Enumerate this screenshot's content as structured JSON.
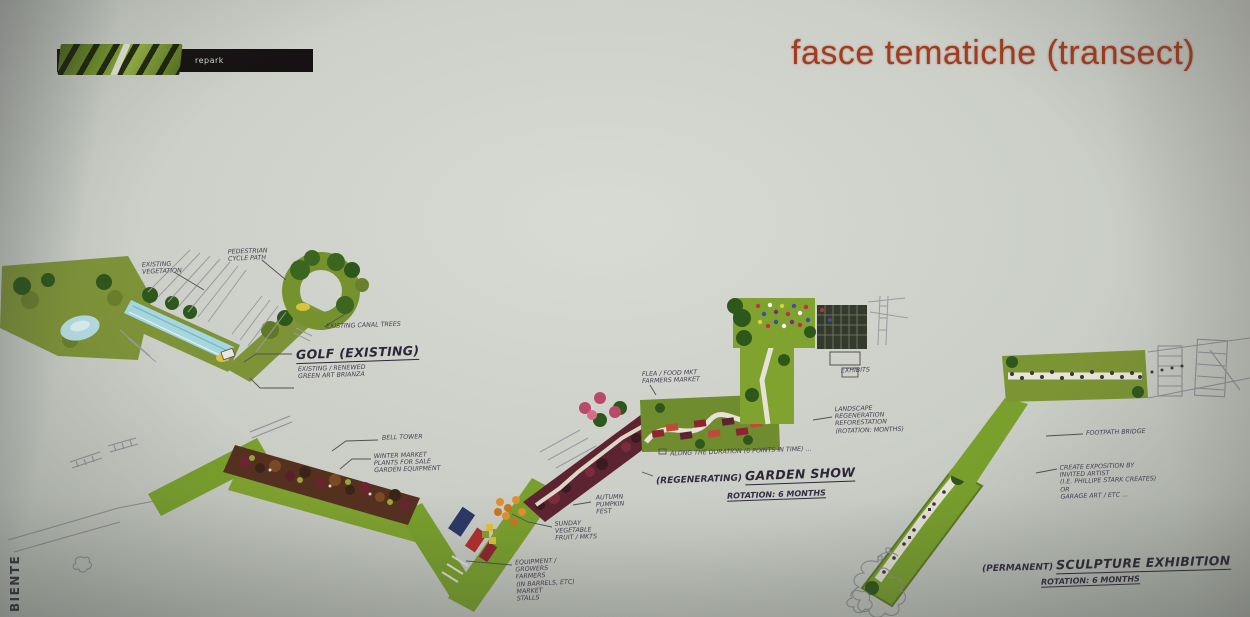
{
  "slide": {
    "logo_text": "repark",
    "title": "fasce tematiche (transect)",
    "side_text": "BIENTE"
  },
  "palette": {
    "title_red": "#a23b1f",
    "slide_bg": "#c9cdc6",
    "band_green": "#79a02c",
    "olive_green": "#7e9338",
    "dark_tree_green": "#2e571c",
    "water_blue": "#a6d6de",
    "planting_maroon": "#5c2330",
    "soil_brown": "#55301f",
    "market_orange": "#e0912f",
    "ink": "#453c50"
  },
  "labels": {
    "golf": {
      "main": "GOLF (EXISTING)",
      "sub": "EXISTING / RENEWED\nGREEN ART BRIANZA",
      "vegetation": "EXISTING\nVEGETATION",
      "path": "PEDESTRIAN\nCYCLE PATH",
      "canal": "EXISTING CANAL TREES"
    },
    "market": {
      "bell": "BELL TOWER",
      "winter": "WINTER MARKET\nPLANTS FOR SALE\nGARDEN EQUIPMENT",
      "autumn": "AUTUMN\nPUMPKIN\nFEST",
      "sunday": "SUNDAY\nVEGETABLE\nFRUIT / MKTS",
      "growers": "EQUIPMENT /\nGROWERS\nFARMERS\n(IN BARRELS, ETC)\nMARKET\nSTALLS"
    },
    "garden_show": {
      "flea": "FLEA / FOOD MKT\nFARMERS MARKET",
      "duration": "ALONG THE DURATION (6 POINTS IN TIME) ...",
      "main_prefix": "(REGENERATING)",
      "main": "GARDEN SHOW",
      "rotation": "ROTATION: 6 MONTHS",
      "landscape": "LANDSCAPE\nREGENERATION\nREFORESTATION\n(ROTATION: MONTHS)",
      "exhibits": "EXHIBITS"
    },
    "sculpture": {
      "footpath": "FOOTPATH BRIDGE",
      "create": "CREATE EXPOSITION BY\nINVITED ARTIST\n(I.E. PHILLIPE STARK CREATES)\nOR\nGARAGE ART / ETC ...",
      "main_prefix": "(PERMANENT)",
      "main": "SCULPTURE EXHIBITION",
      "rotation": "ROTATION: 6 MONTHS"
    }
  }
}
